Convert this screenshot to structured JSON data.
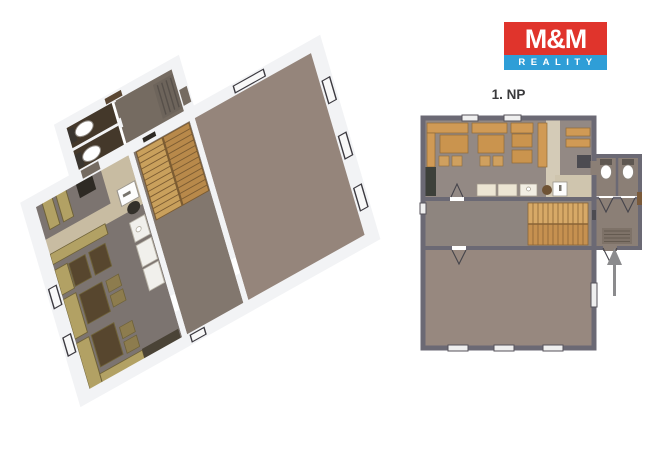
{
  "logo": {
    "brand": "M&M",
    "subbrand": "REALITY",
    "brand_bg_color": "#e0342c",
    "subbrand_bg_color": "#2f9ed7",
    "text_color": "#ffffff"
  },
  "plan": {
    "floor_label": "1. NP"
  },
  "icons": {
    "entrance_arrow": "up-arrow showing entry into building",
    "toilet": "two WC bowls in stalls",
    "doormat": "hatched entrance mat",
    "staircase": "double-flight stairs"
  },
  "colors": {
    "walls_2d": "#6b6974",
    "walls_3d": "#f2f3f5",
    "restaurant_floor": "#938984",
    "hall_floor": "#8e857f",
    "big_room_floor": "#97887f",
    "bench": "#d09a55",
    "stairs_upper": "#d7a967",
    "stairs_lower": "#c69150",
    "kitchen_strip": "#d4cbb7",
    "arrow": "#8b8b8d"
  }
}
